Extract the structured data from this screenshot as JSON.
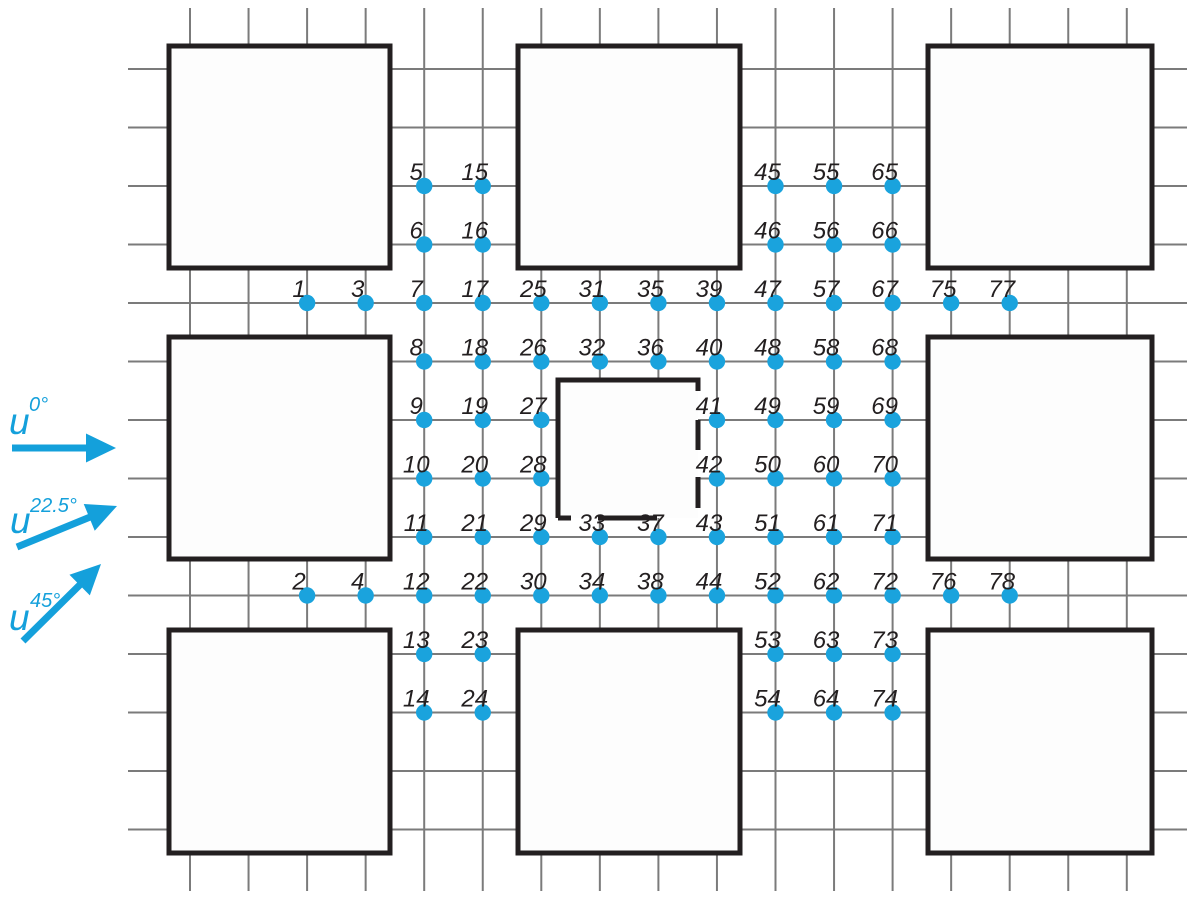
{
  "figure": {
    "description": "Plan view of 3x3 building array with numbered pressure-measurement points on street grid and three wind direction arrows",
    "colors": {
      "background": "#ffffff",
      "grid": "#7b7b7b",
      "building_stroke": "#231f20",
      "building_fill": "#fdfdfd",
      "point": "#1aa3dd",
      "label": "#231f20",
      "arrow": "#14a0db"
    },
    "grid": {
      "x_start": 190,
      "x_step": 58.55,
      "x_count": 17,
      "y_start": 69,
      "y_step": 58.5,
      "y_count": 14,
      "v_y_top": 8,
      "v_y_bottom": 891,
      "h_x_left": 128,
      "h_x_right": 1187,
      "line_width": 2
    },
    "buildings": [
      {
        "id": "top-left",
        "x": 169,
        "y": 46,
        "w": 221,
        "h": 222
      },
      {
        "id": "top-center",
        "x": 518,
        "y": 46,
        "w": 222,
        "h": 222
      },
      {
        "id": "top-right",
        "x": 928,
        "y": 46,
        "w": 224,
        "h": 222
      },
      {
        "id": "middle-left",
        "x": 169,
        "y": 337,
        "w": 221,
        "h": 222
      },
      {
        "id": "middle-right",
        "x": 928,
        "y": 337,
        "w": 224,
        "h": 222
      },
      {
        "id": "bottom-left",
        "x": 169,
        "y": 630,
        "w": 221,
        "h": 223
      },
      {
        "id": "bottom-center",
        "x": 518,
        "y": 630,
        "w": 222,
        "h": 223
      },
      {
        "id": "bottom-right",
        "x": 928,
        "y": 630,
        "w": 224,
        "h": 223
      }
    ],
    "center_building": {
      "id": "center-dashed",
      "x": 558,
      "y": 380,
      "w": 140,
      "h": 138,
      "top_right_stub": 11,
      "right_dash_start": 40,
      "right_dash": "30 27 31 300",
      "bottom_dash": "13 27 59 300",
      "stroke_width": 5
    },
    "points": [
      {
        "n": "1",
        "c": 2,
        "r": 4
      },
      {
        "n": "2",
        "c": 2,
        "r": 9
      },
      {
        "n": "3",
        "c": 3,
        "r": 4
      },
      {
        "n": "4",
        "c": 3,
        "r": 9
      },
      {
        "n": "5",
        "c": 4,
        "r": 2
      },
      {
        "n": "6",
        "c": 4,
        "r": 3
      },
      {
        "n": "7",
        "c": 4,
        "r": 4
      },
      {
        "n": "8",
        "c": 4,
        "r": 5
      },
      {
        "n": "9",
        "c": 4,
        "r": 6
      },
      {
        "n": "10",
        "c": 4,
        "r": 7
      },
      {
        "n": "11",
        "c": 4,
        "r": 8
      },
      {
        "n": "12",
        "c": 4,
        "r": 9
      },
      {
        "n": "13",
        "c": 4,
        "r": 10
      },
      {
        "n": "14",
        "c": 4,
        "r": 11
      },
      {
        "n": "15",
        "c": 5,
        "r": 2
      },
      {
        "n": "16",
        "c": 5,
        "r": 3
      },
      {
        "n": "17",
        "c": 5,
        "r": 4
      },
      {
        "n": "18",
        "c": 5,
        "r": 5
      },
      {
        "n": "19",
        "c": 5,
        "r": 6
      },
      {
        "n": "20",
        "c": 5,
        "r": 7
      },
      {
        "n": "21",
        "c": 5,
        "r": 8
      },
      {
        "n": "22",
        "c": 5,
        "r": 9
      },
      {
        "n": "23",
        "c": 5,
        "r": 10
      },
      {
        "n": "24",
        "c": 5,
        "r": 11
      },
      {
        "n": "25",
        "c": 6,
        "r": 4
      },
      {
        "n": "26",
        "c": 6,
        "r": 5
      },
      {
        "n": "27",
        "c": 6,
        "r": 6
      },
      {
        "n": "28",
        "c": 6,
        "r": 7
      },
      {
        "n": "29",
        "c": 6,
        "r": 8
      },
      {
        "n": "30",
        "c": 6,
        "r": 9
      },
      {
        "n": "31",
        "c": 7,
        "r": 4
      },
      {
        "n": "32",
        "c": 7,
        "r": 5
      },
      {
        "n": "33",
        "c": 7,
        "r": 8
      },
      {
        "n": "34",
        "c": 7,
        "r": 9
      },
      {
        "n": "35",
        "c": 8,
        "r": 4
      },
      {
        "n": "36",
        "c": 8,
        "r": 5
      },
      {
        "n": "37",
        "c": 8,
        "r": 8
      },
      {
        "n": "38",
        "c": 8,
        "r": 9
      },
      {
        "n": "39",
        "c": 9,
        "r": 4
      },
      {
        "n": "40",
        "c": 9,
        "r": 5
      },
      {
        "n": "41",
        "c": 9,
        "r": 6
      },
      {
        "n": "42",
        "c": 9,
        "r": 7
      },
      {
        "n": "43",
        "c": 9,
        "r": 8
      },
      {
        "n": "44",
        "c": 9,
        "r": 9
      },
      {
        "n": "45",
        "c": 10,
        "r": 2
      },
      {
        "n": "46",
        "c": 10,
        "r": 3
      },
      {
        "n": "47",
        "c": 10,
        "r": 4
      },
      {
        "n": "48",
        "c": 10,
        "r": 5
      },
      {
        "n": "49",
        "c": 10,
        "r": 6
      },
      {
        "n": "50",
        "c": 10,
        "r": 7
      },
      {
        "n": "51",
        "c": 10,
        "r": 8
      },
      {
        "n": "52",
        "c": 10,
        "r": 9
      },
      {
        "n": "53",
        "c": 10,
        "r": 10
      },
      {
        "n": "54",
        "c": 10,
        "r": 11
      },
      {
        "n": "55",
        "c": 11,
        "r": 2
      },
      {
        "n": "56",
        "c": 11,
        "r": 3
      },
      {
        "n": "57",
        "c": 11,
        "r": 4
      },
      {
        "n": "58",
        "c": 11,
        "r": 5
      },
      {
        "n": "59",
        "c": 11,
        "r": 6
      },
      {
        "n": "60",
        "c": 11,
        "r": 7
      },
      {
        "n": "61",
        "c": 11,
        "r": 8
      },
      {
        "n": "62",
        "c": 11,
        "r": 9
      },
      {
        "n": "63",
        "c": 11,
        "r": 10
      },
      {
        "n": "64",
        "c": 11,
        "r": 11
      },
      {
        "n": "65",
        "c": 12,
        "r": 2
      },
      {
        "n": "66",
        "c": 12,
        "r": 3
      },
      {
        "n": "67",
        "c": 12,
        "r": 4
      },
      {
        "n": "68",
        "c": 12,
        "r": 5
      },
      {
        "n": "69",
        "c": 12,
        "r": 6
      },
      {
        "n": "70",
        "c": 12,
        "r": 7
      },
      {
        "n": "71",
        "c": 12,
        "r": 8
      },
      {
        "n": "72",
        "c": 12,
        "r": 9
      },
      {
        "n": "73",
        "c": 12,
        "r": 10
      },
      {
        "n": "74",
        "c": 12,
        "r": 11
      },
      {
        "n": "75",
        "c": 13,
        "r": 4
      },
      {
        "n": "76",
        "c": 13,
        "r": 9
      },
      {
        "n": "77",
        "c": 14,
        "r": 4
      },
      {
        "n": "78",
        "c": 14,
        "r": 9
      }
    ],
    "point_style": {
      "radius": 8.2,
      "label_dx": -8,
      "label_dy": -6
    },
    "wind_arrows": [
      {
        "id": "wind-0deg",
        "base": "u",
        "sup": "0°",
        "label": {
          "x": 9,
          "y": 434,
          "sup_x": 29,
          "sup_y": 411
        },
        "tail": {
          "x": 12,
          "y": 448
        },
        "tip": {
          "x": 116,
          "y": 448
        }
      },
      {
        "id": "wind-22.5deg",
        "base": "u",
        "sup": "22.5°",
        "label": {
          "x": 10,
          "y": 533,
          "sup_x": 30,
          "sup_y": 512
        },
        "tail": {
          "x": 17,
          "y": 547
        },
        "tip": {
          "x": 117,
          "y": 506
        }
      },
      {
        "id": "wind-45deg",
        "base": "u",
        "sup": "45°",
        "label": {
          "x": 9,
          "y": 630,
          "sup_x": 30,
          "sup_y": 607
        },
        "tail": {
          "x": 23,
          "y": 641
        },
        "tip": {
          "x": 101,
          "y": 564
        }
      }
    ],
    "arrow_style": {
      "shaft_width": 7,
      "head_length": 30,
      "head_half_width": 14.5
    }
  }
}
